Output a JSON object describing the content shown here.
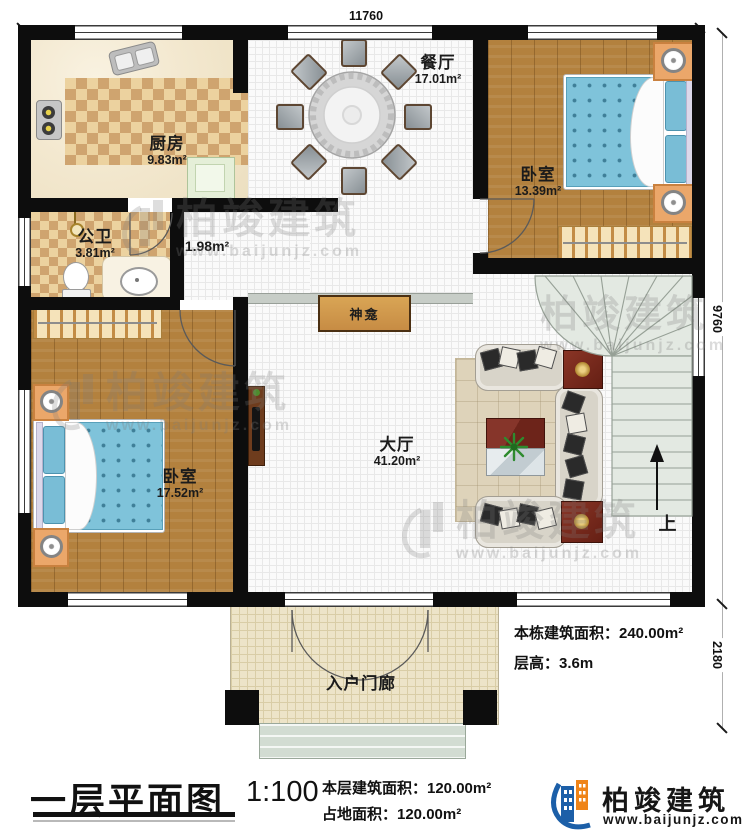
{
  "plan": {
    "title": "一层平面图",
    "scale": "1:100",
    "dims": {
      "top": "11760",
      "right_upper": "9760",
      "right_lower": "2180"
    },
    "rooms": {
      "kitchen": {
        "name": "厨房",
        "area": "9.83m²"
      },
      "bath": {
        "name": "公卫",
        "area": "3.81m²"
      },
      "hallway": {
        "area": "1.98m²"
      },
      "dining": {
        "name": "餐厅",
        "area": "17.01m²"
      },
      "bedroom_right": {
        "name": "卧室",
        "area": "13.39m²"
      },
      "bedroom_left": {
        "name": "卧室",
        "area": "17.52m²"
      },
      "hall": {
        "name": "大厅",
        "area": "41.20m²"
      },
      "porch": {
        "name": "入户门廊"
      },
      "shrine": {
        "name": "神龛"
      }
    },
    "stairs": {
      "up": "上"
    }
  },
  "annotations": {
    "building_area": "本栋建筑面积：240.00m²",
    "floor_height": "层高：3.6m",
    "floor_area": "本层建筑面积：120.00m²",
    "land_area": "占地面积：120.00m²"
  },
  "branding": {
    "name": "柏竣建筑",
    "url": "www.baijunjz.com"
  },
  "watermark": {
    "name": "柏竣建筑",
    "url": "www.baijunjz.com"
  }
}
